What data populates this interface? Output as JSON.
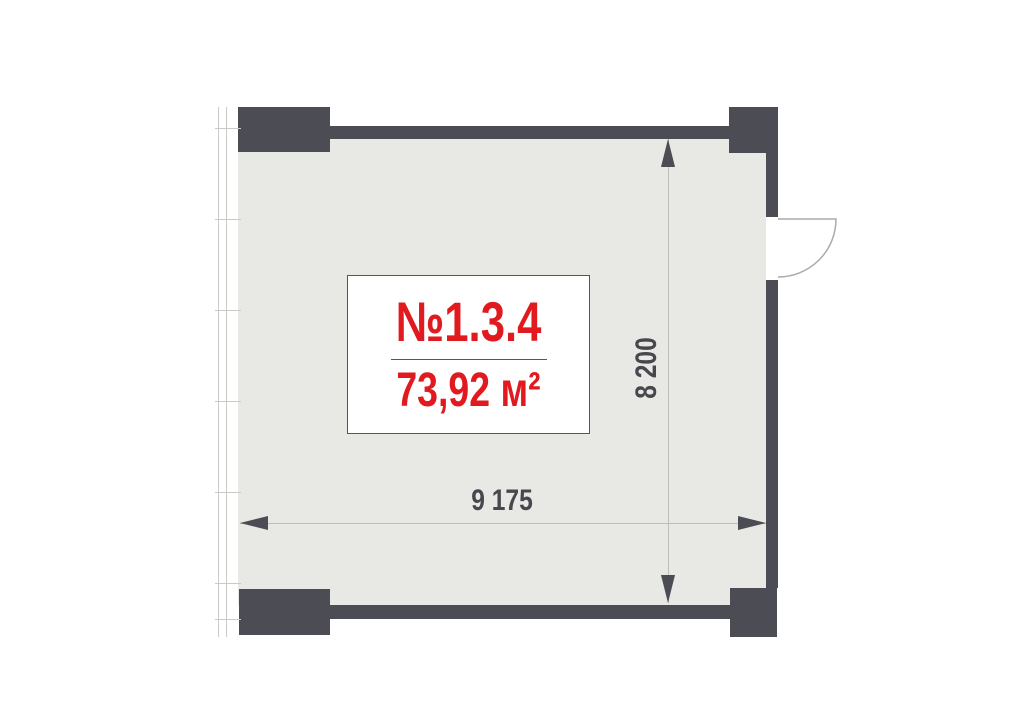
{
  "plan": {
    "unit_number": "№1.3.4",
    "area": "73,92 м²",
    "dimensions": {
      "width_label": "9 175",
      "height_label": "8 200"
    },
    "colors": {
      "wall": "#4c4c54",
      "floor": "#e8e8e4",
      "accent_red": "#e11a20",
      "dimension_text": "#47474e",
      "dimension_line": "#bdbdb9",
      "glazing_line": "#c9c9c5",
      "door_line": "#aaaaa6"
    }
  }
}
